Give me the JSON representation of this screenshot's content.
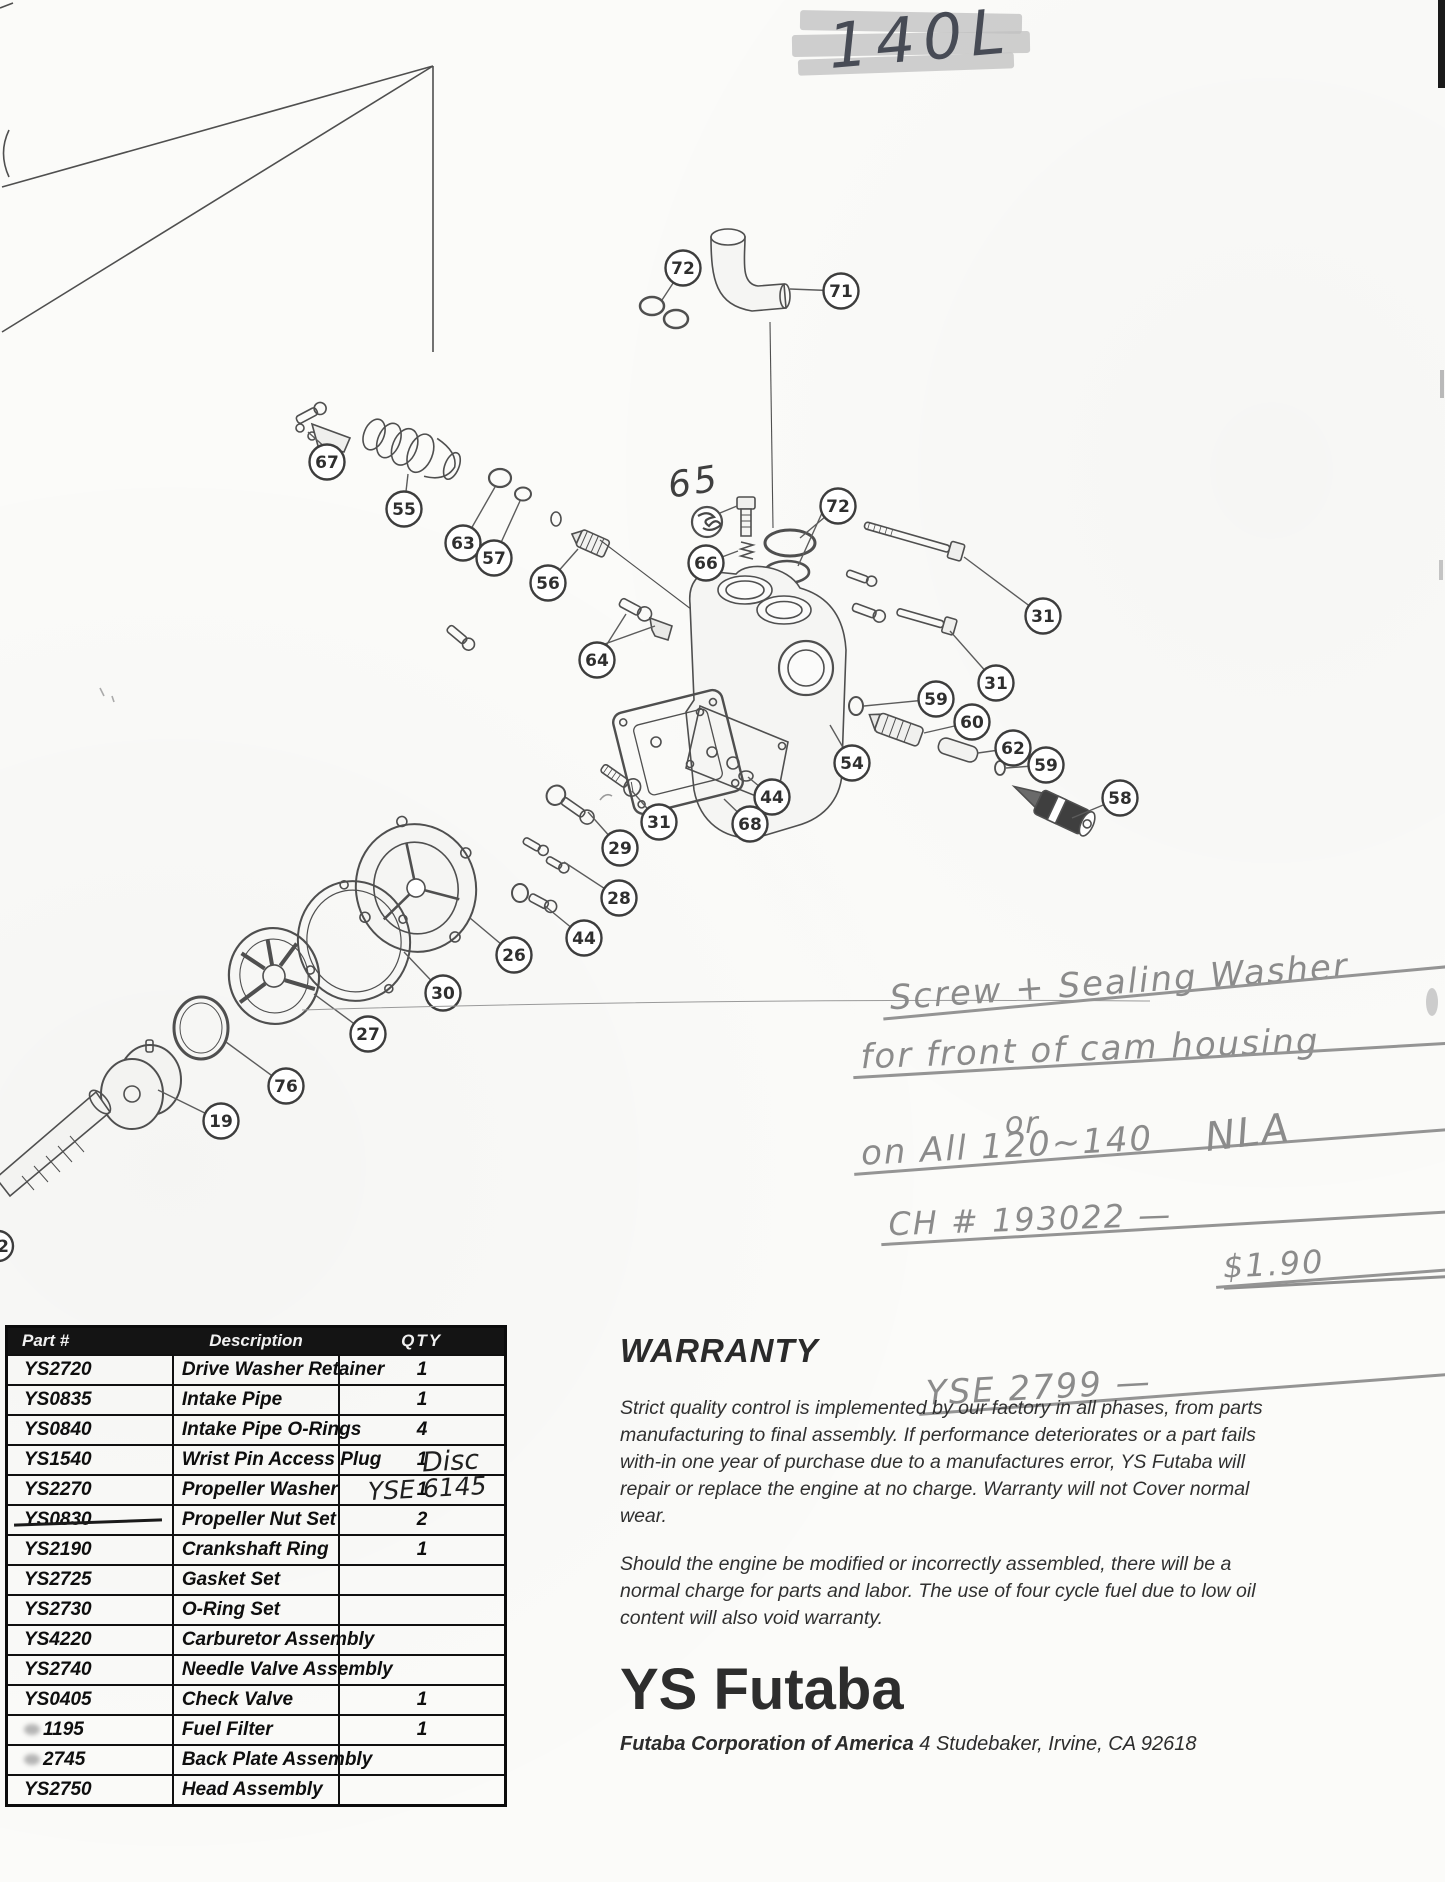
{
  "header": {
    "model_label": "140L"
  },
  "diagram": {
    "partial_callout": "2",
    "annotation_65": "65",
    "balloons": [
      {
        "n": "72",
        "x": 683,
        "y": 268,
        "tx": 662,
        "ty": 300
      },
      {
        "n": "71",
        "x": 841,
        "y": 291,
        "tx": 790,
        "ty": 289
      },
      {
        "n": "67",
        "x": 327,
        "y": 462,
        "tx": 330,
        "ty": 446
      },
      {
        "n": "55",
        "x": 404,
        "y": 509,
        "tx": 408,
        "ty": 474
      },
      {
        "n": "63",
        "x": 463,
        "y": 543,
        "tx": 495,
        "ty": 487
      },
      {
        "n": "57",
        "x": 494,
        "y": 558,
        "tx": 520,
        "ty": 501
      },
      {
        "n": "56",
        "x": 548,
        "y": 583,
        "tx": 578,
        "ty": 549
      },
      {
        "n": "66",
        "x": 706,
        "y": 563,
        "tx": 738,
        "ty": 551
      },
      {
        "n": "72",
        "x": 838,
        "y": 506,
        "tx": 800,
        "ty": 538
      },
      {
        "n": "31",
        "x": 1043,
        "y": 616,
        "tx": 964,
        "ty": 557
      },
      {
        "n": "31",
        "x": 996,
        "y": 683,
        "tx": 950,
        "ty": 631
      },
      {
        "n": "59",
        "x": 936,
        "y": 699,
        "tx": 864,
        "ty": 706
      },
      {
        "n": "60",
        "x": 972,
        "y": 722,
        "tx": 924,
        "ty": 733
      },
      {
        "n": "62",
        "x": 1013,
        "y": 748,
        "tx": 978,
        "ty": 753
      },
      {
        "n": "59",
        "x": 1046,
        "y": 765,
        "tx": 1006,
        "ty": 768
      },
      {
        "n": "58",
        "x": 1120,
        "y": 798,
        "tx": 1072,
        "ty": 818
      },
      {
        "n": "54",
        "x": 852,
        "y": 763,
        "tx": 830,
        "ty": 725
      },
      {
        "n": "44",
        "x": 772,
        "y": 797,
        "tx": 748,
        "ty": 777
      },
      {
        "n": "68",
        "x": 750,
        "y": 824,
        "tx": 724,
        "ty": 799
      },
      {
        "n": "64",
        "x": 597,
        "y": 660,
        "tx": 626,
        "ty": 614
      },
      {
        "n": "31",
        "x": 659,
        "y": 822,
        "tx": 632,
        "ty": 791
      },
      {
        "n": "29",
        "x": 620,
        "y": 848,
        "tx": 588,
        "ty": 812
      },
      {
        "n": "28",
        "x": 619,
        "y": 898,
        "tx": 564,
        "ty": 862
      },
      {
        "n": "44",
        "x": 584,
        "y": 938,
        "tx": 545,
        "ty": 906
      },
      {
        "n": "26",
        "x": 514,
        "y": 955,
        "tx": 470,
        "ty": 918
      },
      {
        "n": "30",
        "x": 443,
        "y": 993,
        "tx": 404,
        "ty": 952
      },
      {
        "n": "27",
        "x": 368,
        "y": 1034,
        "tx": 314,
        "ty": 994
      },
      {
        "n": "76",
        "x": 286,
        "y": 1086,
        "tx": 226,
        "ty": 1042
      },
      {
        "n": "19",
        "x": 221,
        "y": 1121,
        "tx": 158,
        "ty": 1090
      }
    ]
  },
  "notes": {
    "lines": [
      {
        "text": "Screw + Sealing Washer",
        "x": 888,
        "y": 928,
        "size": 34,
        "rot": -4,
        "strike": true,
        "underline": false
      },
      {
        "text": "for front of cam housing",
        "x": 860,
        "y": 972,
        "size": 34,
        "rot": -2,
        "strike": true,
        "underline": false
      },
      {
        "text": "on All 120~140",
        "x": 860,
        "y": 1016,
        "size": 34,
        "rot": -3,
        "strike": true,
        "underline": false
      },
      {
        "text": "CH # 193022 —",
        "x": 888,
        "y": 1060,
        "size": 32,
        "rot": -2,
        "strike": true,
        "underline": false
      },
      {
        "text": "$1.90",
        "x": 1222,
        "y": 1052,
        "size": 32,
        "rot": -3,
        "strike": true,
        "underline": true
      },
      {
        "text": "or",
        "x": 1005,
        "y": 1106,
        "size": 30,
        "rot": 0,
        "strike": false,
        "underline": false
      },
      {
        "text": "YSE 2799 —",
        "x": 925,
        "y": 1136,
        "size": 34,
        "rot": -3,
        "strike": true,
        "underline": false
      },
      {
        "text": "NLA",
        "x": 1205,
        "y": 1110,
        "size": 40,
        "rot": -7,
        "strike": false,
        "underline": false
      }
    ]
  },
  "table": {
    "headers": [
      "Part #",
      "Description",
      "QTY"
    ],
    "rows": [
      {
        "part": "YS2720",
        "desc": "Drive Washer Retainer",
        "qty": "1",
        "struck": false,
        "smudged": false
      },
      {
        "part": "YS0835",
        "desc": "Intake Pipe",
        "qty": "1",
        "struck": false,
        "smudged": false
      },
      {
        "part": "YS0840",
        "desc": "Intake Pipe O-Rings",
        "qty": "4",
        "struck": false,
        "smudged": false
      },
      {
        "part": "YS1540",
        "desc": "Wrist Pin Access Plug",
        "qty": "1",
        "struck": false,
        "smudged": false
      },
      {
        "part": "YS2270",
        "desc": "Propeller Washer",
        "qty": "1",
        "struck": false,
        "smudged": false
      },
      {
        "part": "YS0830",
        "desc": "Propeller Nut Set",
        "qty": "2",
        "struck": true,
        "smudged": false
      },
      {
        "part": "YS2190",
        "desc": "Crankshaft Ring",
        "qty": "1",
        "struck": false,
        "smudged": false
      },
      {
        "part": "YS2725",
        "desc": "Gasket Set",
        "qty": "",
        "struck": false,
        "smudged": false
      },
      {
        "part": "YS2730",
        "desc": "O-Ring Set",
        "qty": "",
        "struck": false,
        "smudged": false
      },
      {
        "part": "YS4220",
        "desc": "Carburetor Assembly",
        "qty": "",
        "struck": false,
        "smudged": false
      },
      {
        "part": "YS2740",
        "desc": "Needle Valve Assembly",
        "qty": "",
        "struck": false,
        "smudged": false
      },
      {
        "part": "YS0405",
        "desc": "Check Valve",
        "qty": "1",
        "struck": false,
        "smudged": false
      },
      {
        "part": "1195",
        "desc": "Fuel Filter",
        "qty": "1",
        "struck": false,
        "smudged": true
      },
      {
        "part": "2745",
        "desc": "Back Plate Assembly",
        "qty": "",
        "struck": false,
        "smudged": true
      },
      {
        "part": "YS2750",
        "desc": "Head Assembly",
        "qty": "",
        "struck": false,
        "smudged": false
      }
    ],
    "annotations": [
      {
        "text": "Disc",
        "x": 422,
        "y": 1446,
        "size": 27,
        "rot": -3
      },
      {
        "text": "YSE 6145",
        "x": 368,
        "y": 1474,
        "size": 25,
        "rot": -3
      }
    ]
  },
  "warranty": {
    "title": "WARRANTY",
    "p1": "Strict quality control is implemented by our factory in all phases, from parts manufacturing to final assembly. If performance deteriorates or a part fails with-in one year of purchase due to a manufactures error, YS Futaba will repair or replace the engine at no charge. Warranty will not Cover normal wear.",
    "p2": "Should the engine be modified or incorrectly assembled, there will be a normal charge for parts and labor. The use of four cycle fuel due to low oil content will also void warranty.",
    "logo": "YS Futaba",
    "address_bold": "Futaba Corporation of America",
    "address_rest": " 4 Studebaker, Irvine, CA 92618"
  }
}
